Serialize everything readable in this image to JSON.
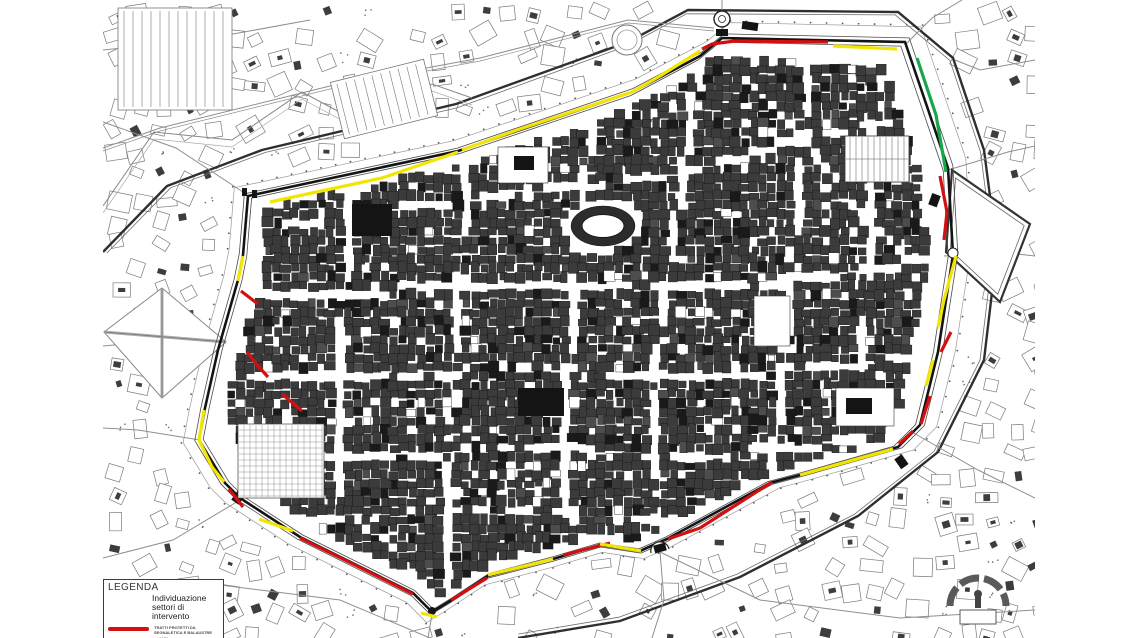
{
  "legend": {
    "title": "LEGENDA",
    "subtitle": "Individuazione settori di intervento",
    "entries": [
      {
        "color": "#d40f0f",
        "label": "TRATTI PROTETTI DA SEGNALETICA E BALAUSTRE",
        "measure": "ml 1528"
      },
      {
        "color": "#f2e600",
        "label": "TRATTO PROTETTO DA SEGNALETICA",
        "measure": "ml 1940"
      }
    ]
  },
  "map": {
    "colors": {
      "red": "#d40f0f",
      "yellow": "#f2e600",
      "green": "#17a649"
    },
    "wall": [
      [
        248,
        196
      ],
      [
        458,
        151
      ],
      [
        632,
        92
      ],
      [
        700,
        56
      ],
      [
        722,
        38
      ],
      [
        905,
        42
      ],
      [
        948,
        168
      ],
      [
        953,
        255
      ],
      [
        938,
        352
      ],
      [
        920,
        425
      ],
      [
        898,
        447
      ],
      [
        800,
        475
      ],
      [
        770,
        483
      ],
      [
        667,
        539
      ],
      [
        640,
        551
      ],
      [
        600,
        545
      ],
      [
        553,
        559
      ],
      [
        488,
        576
      ],
      [
        450,
        601
      ],
      [
        432,
        612
      ],
      [
        413,
        593
      ],
      [
        300,
        537
      ],
      [
        240,
        498
      ],
      [
        225,
        483
      ],
      [
        199,
        440
      ],
      [
        205,
        408
      ],
      [
        218,
        350
      ],
      [
        238,
        280
      ],
      [
        243,
        255
      ]
    ],
    "route_segments": [
      {
        "color": "red",
        "points": [
          [
            828,
            42
          ],
          [
            735,
            41
          ],
          [
            712,
            44
          ],
          [
            702,
            49
          ]
        ]
      },
      {
        "color": "red",
        "points": [
          [
            940,
            176
          ],
          [
            947,
            212
          ],
          [
            944,
            240
          ]
        ]
      },
      {
        "color": "red",
        "points": [
          [
            951,
            332
          ],
          [
            941,
            352
          ]
        ]
      },
      {
        "color": "red",
        "points": [
          [
            930,
            396
          ],
          [
            921,
            424
          ]
        ]
      },
      {
        "color": "red",
        "points": [
          [
            913,
            431
          ],
          [
            899,
            444
          ]
        ]
      },
      {
        "color": "red",
        "points": [
          [
            772,
            482
          ],
          [
            700,
            528
          ],
          [
            668,
            539
          ]
        ]
      },
      {
        "color": "red",
        "points": [
          [
            610,
            543
          ],
          [
            563,
            555
          ]
        ]
      },
      {
        "color": "red",
        "points": [
          [
            487,
            578
          ],
          [
            451,
            600
          ]
        ]
      },
      {
        "color": "red",
        "points": [
          [
            413,
            594
          ],
          [
            355,
            565
          ],
          [
            300,
            538
          ]
        ]
      },
      {
        "color": "red",
        "points": [
          [
            243,
            507
          ],
          [
            229,
            489
          ]
        ]
      },
      {
        "color": "red",
        "points": [
          [
            258,
            304
          ],
          [
            241,
            291
          ]
        ]
      },
      {
        "color": "red",
        "points": [
          [
            247,
            352
          ],
          [
            258,
            366
          ],
          [
            268,
            377
          ]
        ]
      },
      {
        "color": "red",
        "points": [
          [
            282,
            394
          ],
          [
            302,
            411
          ]
        ]
      },
      {
        "color": "yellow",
        "points": [
          [
            833,
            46
          ],
          [
            897,
            49
          ]
        ]
      },
      {
        "color": "yellow",
        "points": [
          [
            700,
            51
          ],
          [
            660,
            76
          ],
          [
            632,
            92
          ],
          [
            520,
            129
          ],
          [
            462,
            150
          ]
        ]
      },
      {
        "color": "yellow",
        "points": [
          [
            458,
            152
          ],
          [
            382,
            178
          ],
          [
            270,
            202
          ]
        ]
      },
      {
        "color": "yellow",
        "points": [
          [
            243,
            256
          ],
          [
            238,
            281
          ]
        ]
      },
      {
        "color": "yellow",
        "points": [
          [
            204,
            410
          ],
          [
            199,
            440
          ],
          [
            212,
            467
          ],
          [
            224,
            482
          ]
        ]
      },
      {
        "color": "yellow",
        "points": [
          [
            259,
            519
          ],
          [
            293,
            531
          ]
        ]
      },
      {
        "color": "yellow",
        "points": [
          [
            488,
            575
          ],
          [
            553,
            559
          ]
        ]
      },
      {
        "color": "yellow",
        "points": [
          [
            600,
            544
          ],
          [
            641,
            551
          ]
        ]
      },
      {
        "color": "yellow",
        "points": [
          [
            421,
            613
          ],
          [
            437,
            617
          ]
        ]
      },
      {
        "color": "yellow",
        "points": [
          [
            800,
            475
          ],
          [
            893,
            449
          ]
        ]
      },
      {
        "color": "yellow",
        "points": [
          [
            956,
            256
          ],
          [
            944,
            300
          ],
          [
            938,
            327
          ]
        ]
      },
      {
        "color": "yellow",
        "points": [
          [
            933,
            360
          ],
          [
            926,
            386
          ]
        ]
      },
      {
        "color": "green",
        "points": [
          [
            917,
            58
          ],
          [
            936,
            115
          ],
          [
            946,
            172
          ]
        ]
      }
    ]
  }
}
